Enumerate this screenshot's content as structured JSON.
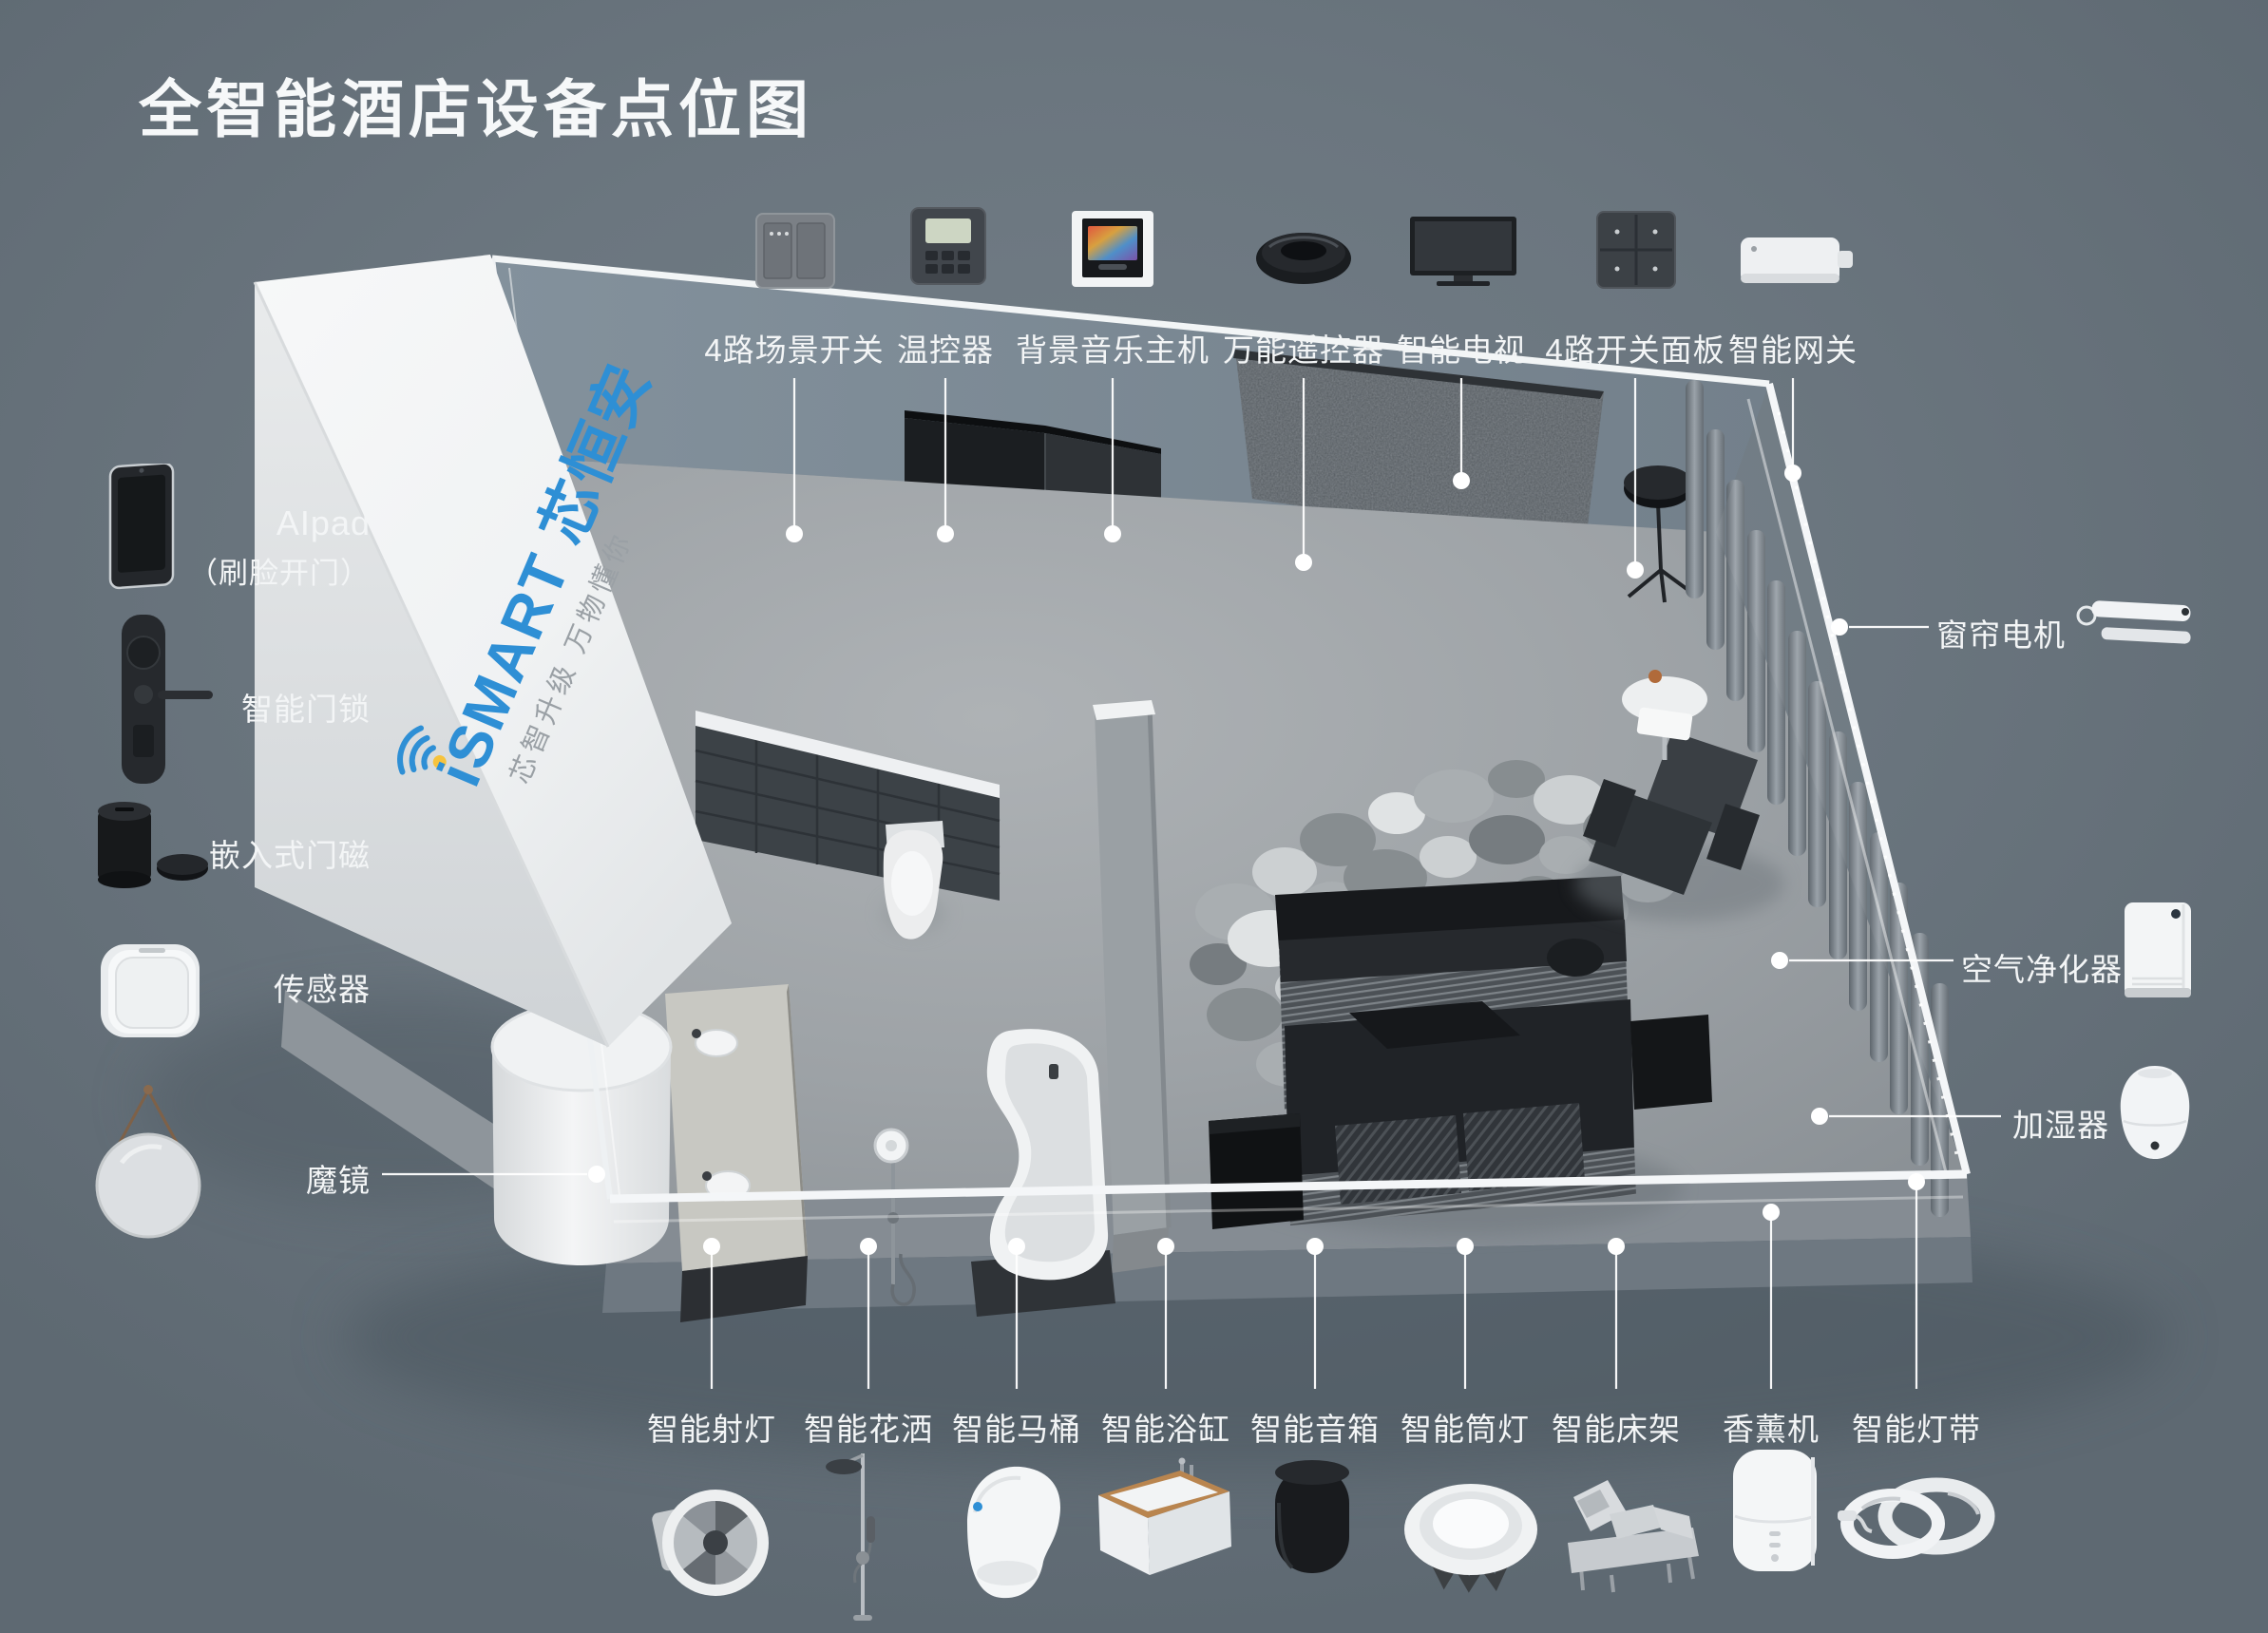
{
  "title": "全智能酒店设备点位图",
  "brand": {
    "logo": "iSMART 芯恒安",
    "tagline": "芯智升级  万物懂你"
  },
  "legend_top": [
    {
      "label": "4路场景开关",
      "icon": "scene-switch-icon"
    },
    {
      "label": "温控器",
      "icon": "thermostat-icon"
    },
    {
      "label": "背景音乐主机",
      "icon": "music-host-icon"
    },
    {
      "label": "万能遥控器",
      "icon": "universal-remote-icon"
    },
    {
      "label": "智能电视",
      "icon": "smart-tv-icon"
    },
    {
      "label": "4路开关面板",
      "icon": "switch-panel-icon"
    },
    {
      "label": "智能网关",
      "icon": "gateway-icon"
    }
  ],
  "legend_left": [
    {
      "label": "AIpad",
      "sublabel": "（刷脸开门）",
      "icon": "aipad-icon"
    },
    {
      "label": "智能门锁",
      "icon": "door-lock-icon"
    },
    {
      "label": "嵌入式门磁",
      "icon": "door-magnet-icon"
    },
    {
      "label": "传感器",
      "icon": "sensor-icon"
    },
    {
      "label": "魔镜",
      "icon": "magic-mirror-icon"
    }
  ],
  "legend_right": [
    {
      "label": "窗帘电机",
      "icon": "curtain-motor-icon"
    },
    {
      "label": "空气净化器",
      "icon": "air-purifier-icon"
    },
    {
      "label": "加湿器",
      "icon": "humidifier-icon"
    }
  ],
  "legend_bottom": [
    {
      "label": "智能射灯",
      "icon": "spotlight-icon"
    },
    {
      "label": "智能花洒",
      "icon": "shower-icon"
    },
    {
      "label": "智能马桶",
      "icon": "toilet-icon"
    },
    {
      "label": "智能浴缸",
      "icon": "bathtub-icon"
    },
    {
      "label": "智能音箱",
      "icon": "speaker-icon"
    },
    {
      "label": "智能筒灯",
      "icon": "downlight-icon"
    },
    {
      "label": "智能床架",
      "icon": "bed-frame-icon"
    },
    {
      "label": "香薰机",
      "icon": "aroma-diffuser-icon"
    },
    {
      "label": "智能灯带",
      "icon": "light-strip-icon"
    }
  ],
  "colors": {
    "background": "#6b767f",
    "accent_blue": "#2e8fd5",
    "label_text": "#f3f5f6",
    "logo_dot_yellow": "#f6c33d"
  }
}
